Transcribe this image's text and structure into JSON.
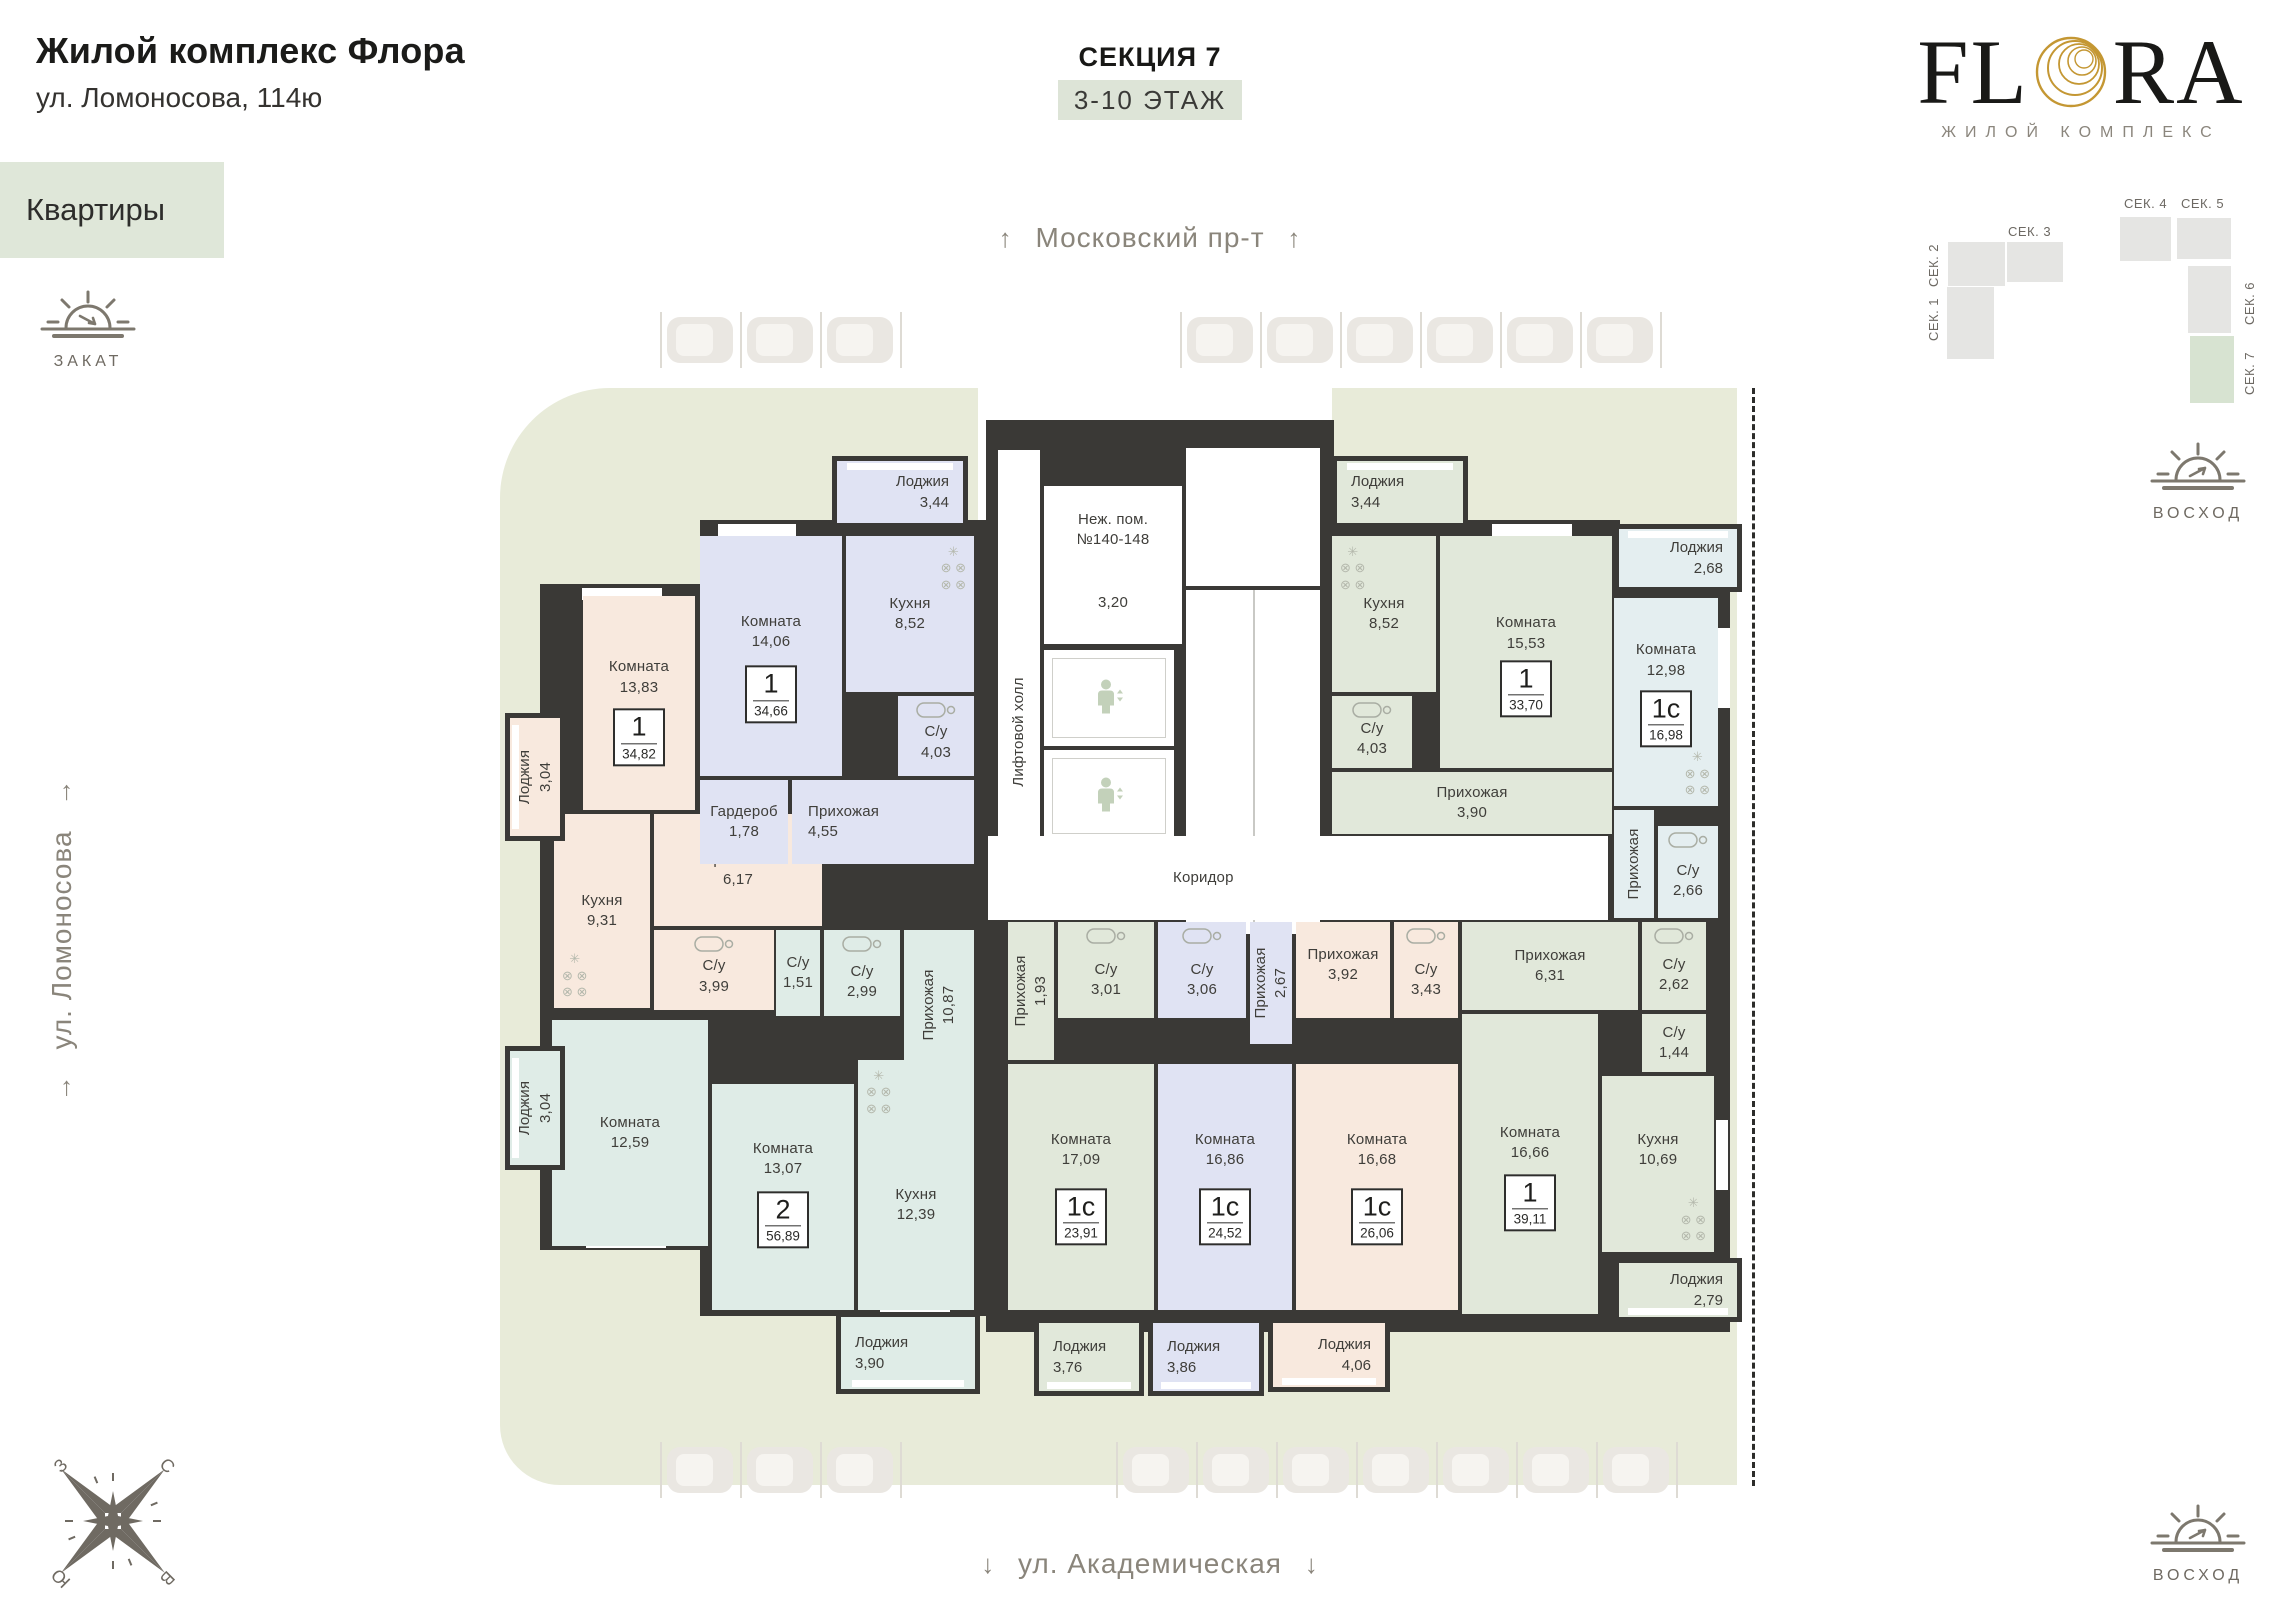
{
  "header": {
    "title": "Жилой комплекс Флора",
    "address": "ул. Ломоносова, 114ю",
    "nav_label": "Квартиры",
    "section_title": "СЕКЦИЯ 7",
    "floors_label": "3-10 ЭТАЖ"
  },
  "logo": {
    "pre": "FL",
    "post": "RA",
    "subtitle": "ЖИЛОЙ КОМПЛЕКС"
  },
  "site_map": {
    "sections": [
      {
        "label": "СЕК. 1"
      },
      {
        "label": "СЕК. 2"
      },
      {
        "label": "СЕК. 3"
      },
      {
        "label": "СЕК. 4"
      },
      {
        "label": "СЕК. 5"
      },
      {
        "label": "СЕК. 6"
      },
      {
        "label": "СЕК. 7"
      }
    ]
  },
  "streets": {
    "top": {
      "text": "Московский пр-т",
      "arrow": "↑"
    },
    "bottom": {
      "text": "ул. Академическая",
      "arrow": "↓"
    },
    "left": {
      "text": "ул. Ломоносова",
      "arrow": "→"
    }
  },
  "sun": {
    "sunset": "ЗАКАТ",
    "sunrise": "ВОСХОД"
  },
  "compass": {
    "n": "С",
    "e": "В",
    "s": "Ю",
    "w": "З"
  },
  "colors": {
    "beige": "#f8e9de",
    "blue": "#e0e3f3",
    "green": "#e1e8da",
    "teal": "#dfece7",
    "cyan": "#e4eef0",
    "white": "#ffffff",
    "wall": "#3a3936",
    "sage": "#e8ebd9",
    "gold": "#c49733",
    "nav_bg": "#dfe7d9",
    "map_active": "#d7e3d1"
  },
  "plan": {
    "rooms": [
      {
        "id": "komnata-13-83",
        "label": "Комната",
        "area": "13,83",
        "x": 583,
        "y": 596,
        "w": 112,
        "h": 214,
        "c": "beige",
        "badge": {
          "t": "1",
          "a": "34,82"
        },
        "ly": 0.38,
        "by": 0.66
      },
      {
        "id": "kuhnya-9-31",
        "label": "Кухня",
        "area": "9,31",
        "x": 554,
        "y": 814,
        "w": 96,
        "h": 194,
        "c": "beige",
        "fx": "kitchen",
        "fxp": "bl"
      },
      {
        "id": "prihozhaya-6-17",
        "label": "Прихожая",
        "area": "6,17",
        "x": 654,
        "y": 814,
        "w": 168,
        "h": 112,
        "c": "beige"
      },
      {
        "id": "su-3-99",
        "label": "С/у",
        "area": "3,99",
        "x": 654,
        "y": 930,
        "w": 120,
        "h": 80,
        "c": "beige",
        "fx": "bath",
        "ly": 0.58
      },
      {
        "id": "komnata-14-06",
        "label": "Комната",
        "area": "14,06",
        "x": 700,
        "y": 536,
        "w": 142,
        "h": 240,
        "c": "blue",
        "badge": {
          "t": "1",
          "a": "34,66"
        },
        "ly": 0.4,
        "by": 0.66
      },
      {
        "id": "kuhnya-8-52a",
        "label": "Кухня",
        "area": "8,52",
        "x": 846,
        "y": 536,
        "w": 128,
        "h": 156,
        "c": "blue",
        "fx": "kitchen",
        "fxp": "tr"
      },
      {
        "id": "garderob-1-78",
        "label": "Гардероб",
        "area": "1,78",
        "x": 700,
        "y": 780,
        "w": 88,
        "h": 84,
        "c": "blue"
      },
      {
        "id": "prihozhaya-4-55",
        "label": "Прихожая",
        "area": "4,55",
        "x": 792,
        "y": 780,
        "w": 182,
        "h": 84,
        "c": "blue",
        "align": "left",
        "pad": 16
      },
      {
        "id": "su-4-03a",
        "label": "С/у",
        "area": "4,03",
        "x": 898,
        "y": 696,
        "w": 76,
        "h": 80,
        "c": "blue",
        "fx": "bath",
        "ly": 0.58
      },
      {
        "id": "kuhnya-8-52b",
        "label": "Кухня",
        "area": "8,52",
        "x": 1332,
        "y": 536,
        "w": 104,
        "h": 156,
        "c": "green",
        "fx": "kitchen",
        "fxp": "tl"
      },
      {
        "id": "komnata-15-53",
        "label": "Комната",
        "area": "15,53",
        "x": 1440,
        "y": 536,
        "w": 172,
        "h": 232,
        "c": "green",
        "badge": {
          "t": "1",
          "a": "33,70"
        },
        "ly": 0.42,
        "by": 0.66
      },
      {
        "id": "su-4-03b",
        "label": "С/у",
        "area": "4,03",
        "x": 1332,
        "y": 696,
        "w": 80,
        "h": 72,
        "c": "green",
        "fx": "bath",
        "ly": 0.6
      },
      {
        "id": "prihozhaya-3-90",
        "label": "Прихожая",
        "area": "3,90",
        "x": 1332,
        "y": 772,
        "w": 280,
        "h": 62,
        "c": "green"
      },
      {
        "id": "komnata-12-98",
        "label": "Комната",
        "area": "12,98",
        "x": 1614,
        "y": 598,
        "w": 104,
        "h": 208,
        "c": "cyan",
        "badge": {
          "t": "1с",
          "a": "16,98"
        },
        "ly": 0.3,
        "by": 0.58,
        "fx": "kitchen",
        "fxp": "br"
      },
      {
        "id": "prihozhaya-v",
        "label": "Прихожая",
        "area": "",
        "x": 1614,
        "y": 810,
        "w": 40,
        "h": 108,
        "c": "cyan",
        "vertical": true
      },
      {
        "id": "su-2-66",
        "label": "С/у",
        "area": "2,66",
        "x": 1658,
        "y": 826,
        "w": 60,
        "h": 92,
        "c": "cyan",
        "fx": "bath",
        "ly": 0.6
      },
      {
        "id": "lift-hall",
        "label": "Лифтовой холл",
        "area": "",
        "x": 998,
        "y": 450,
        "w": 42,
        "h": 470,
        "c": "white",
        "vertical": true,
        "ly": 0.6
      },
      {
        "id": "nezh-pom",
        "label": "Неж. пом.",
        "label2": "№140-148",
        "area": "3,20",
        "x": 1044,
        "y": 486,
        "w": 138,
        "h": 158,
        "c": "white",
        "ly": 0.28,
        "by": 0.74
      },
      {
        "id": "elevator-a",
        "label": "",
        "area": "",
        "x": 1044,
        "y": 650,
        "w": 130,
        "h": 96,
        "c": "white",
        "icon": "elevator"
      },
      {
        "id": "elevator-b",
        "label": "",
        "area": "",
        "x": 1044,
        "y": 750,
        "w": 130,
        "h": 92,
        "c": "white",
        "icon": "elevator"
      },
      {
        "id": "stairs-landing",
        "label": "",
        "area": "",
        "x": 1186,
        "y": 448,
        "w": 134,
        "h": 138,
        "c": "white"
      },
      {
        "id": "stairs",
        "label": "",
        "area": "",
        "x": 1186,
        "y": 590,
        "w": 134,
        "h": 344,
        "c": "white",
        "pattern": "stairs"
      },
      {
        "id": "corridor",
        "label": "Коридор",
        "area": "",
        "x": 988,
        "y": 836,
        "w": 620,
        "h": 84,
        "c": "white",
        "align": "left",
        "pad": 185
      },
      {
        "id": "su-1-51",
        "label": "С/у",
        "area": "1,51",
        "x": 776,
        "y": 930,
        "w": 44,
        "h": 86,
        "c": "teal"
      },
      {
        "id": "su-2-99",
        "label": "С/у",
        "area": "2,99",
        "x": 824,
        "y": 930,
        "w": 76,
        "h": 86,
        "c": "teal",
        "fx": "bath",
        "ly": 0.6
      },
      {
        "id": "prihozhaya-10-87",
        "label": "Прихожая",
        "area": "10,87",
        "x": 904,
        "y": 930,
        "w": 70,
        "h": 150,
        "c": "teal",
        "vertical": true
      },
      {
        "id": "komnata-12-59",
        "label": "Комната",
        "area": "12,59",
        "x": 552,
        "y": 1020,
        "w": 156,
        "h": 226,
        "c": "teal"
      },
      {
        "id": "komnata-13-07",
        "label": "Комната",
        "area": "13,07",
        "x": 712,
        "y": 1084,
        "w": 142,
        "h": 226,
        "c": "teal",
        "badge": {
          "t": "2",
          "a": "56,89"
        },
        "ly": 0.33,
        "by": 0.6
      },
      {
        "id": "kuhnya-12-39",
        "label": "Кухня",
        "area": "12,39",
        "x": 858,
        "y": 1060,
        "w": 116,
        "h": 250,
        "c": "teal",
        "ly": 0.58,
        "fx": "kitchen",
        "fxp": "tl"
      },
      {
        "id": "prihozhaya-1-93",
        "label": "Прихожая",
        "area": "1,93",
        "x": 1008,
        "y": 922,
        "w": 46,
        "h": 138,
        "c": "green",
        "vertical": true
      },
      {
        "id": "su-3-01",
        "label": "С/у",
        "area": "3,01",
        "x": 1058,
        "y": 922,
        "w": 96,
        "h": 96,
        "c": "green",
        "fx": "bath",
        "ly": 0.6
      },
      {
        "id": "komnata-17-09",
        "label": "Комната",
        "area": "17,09",
        "x": 1008,
        "y": 1064,
        "w": 146,
        "h": 246,
        "c": "green",
        "badge": {
          "t": "1с",
          "a": "23,91"
        },
        "ly": 0.35,
        "by": 0.62
      },
      {
        "id": "su-3-06",
        "label": "С/у",
        "area": "3,06",
        "x": 1158,
        "y": 922,
        "w": 88,
        "h": 96,
        "c": "blue",
        "fx": "bath",
        "ly": 0.6
      },
      {
        "id": "prihozhaya-2-67",
        "label": "Прихожая",
        "area": "2,67",
        "x": 1250,
        "y": 922,
        "w": 42,
        "h": 122,
        "c": "blue",
        "vertical": true
      },
      {
        "id": "komnata-16-86",
        "label": "Комната",
        "area": "16,86",
        "x": 1158,
        "y": 1064,
        "w": 134,
        "h": 246,
        "c": "blue",
        "badge": {
          "t": "1с",
          "a": "24,52"
        },
        "ly": 0.35,
        "by": 0.62
      },
      {
        "id": "prihozhaya-3-92",
        "label": "Прихожая",
        "area": "3,92",
        "x": 1296,
        "y": 922,
        "w": 94,
        "h": 96,
        "c": "beige",
        "ly": 0.45
      },
      {
        "id": "su-3-43",
        "label": "С/у",
        "area": "3,43",
        "x": 1394,
        "y": 922,
        "w": 64,
        "h": 96,
        "c": "beige",
        "fx": "bath",
        "ly": 0.6
      },
      {
        "id": "komnata-16-68",
        "label": "Комната",
        "area": "16,68",
        "x": 1296,
        "y": 1064,
        "w": 162,
        "h": 246,
        "c": "beige",
        "badge": {
          "t": "1с",
          "a": "26,06"
        },
        "ly": 0.35,
        "by": 0.62
      },
      {
        "id": "prihozhaya-6-31",
        "label": "Прихожая",
        "area": "6,31",
        "x": 1462,
        "y": 922,
        "w": 176,
        "h": 88,
        "c": "green"
      },
      {
        "id": "su-2-62",
        "label": "С/у",
        "area": "2,62",
        "x": 1642,
        "y": 922,
        "w": 64,
        "h": 88,
        "c": "green",
        "fx": "bath",
        "ly": 0.6
      },
      {
        "id": "su-1-44",
        "label": "С/у",
        "area": "1,44",
        "x": 1642,
        "y": 1014,
        "w": 64,
        "h": 58,
        "c": "green"
      },
      {
        "id": "komnata-16-66",
        "label": "Комната",
        "area": "16,66",
        "x": 1462,
        "y": 1014,
        "w": 136,
        "h": 300,
        "c": "green",
        "badge": {
          "t": "1",
          "a": "39,11"
        },
        "ly": 0.43,
        "by": 0.63
      },
      {
        "id": "kuhnya-10-69",
        "label": "Кухня",
        "area": "10,69",
        "x": 1602,
        "y": 1076,
        "w": 112,
        "h": 176,
        "c": "green",
        "ly": 0.42,
        "fx": "kitchen",
        "fxp": "br"
      }
    ],
    "loggias": [
      {
        "id": "loggia-3-04a",
        "label": "Лоджия",
        "area": "3,04",
        "x": 505,
        "y": 713,
        "w": 60,
        "h": 128,
        "c": "beige",
        "vertical": true,
        "window": "left"
      },
      {
        "id": "loggia-3-04b",
        "label": "Лоджия",
        "area": "3,04",
        "x": 505,
        "y": 1046,
        "w": 60,
        "h": 124,
        "c": "teal",
        "vertical": true,
        "window": "left"
      },
      {
        "id": "loggia-3-44a",
        "label": "Лоджия",
        "area": "3,44",
        "x": 832,
        "y": 456,
        "w": 136,
        "h": 72,
        "c": "blue",
        "window": "top",
        "align": "right"
      },
      {
        "id": "loggia-3-44b",
        "label": "Лоджия",
        "area": "3,44",
        "x": 1332,
        "y": 456,
        "w": 136,
        "h": 72,
        "c": "green",
        "window": "top",
        "align": "left"
      },
      {
        "id": "loggia-2-68",
        "label": "Лоджия",
        "area": "2,68",
        "x": 1614,
        "y": 524,
        "w": 128,
        "h": 68,
        "c": "cyan",
        "window": "top",
        "align": "right"
      },
      {
        "id": "loggia-3-90",
        "label": "Лоджия",
        "area": "3,90",
        "x": 836,
        "y": 1312,
        "w": 144,
        "h": 82,
        "c": "teal",
        "window": "bottom",
        "align": "left"
      },
      {
        "id": "loggia-3-76",
        "label": "Лоджия",
        "area": "3,76",
        "x": 1034,
        "y": 1318,
        "w": 110,
        "h": 78,
        "c": "green",
        "window": "bottom",
        "align": "left"
      },
      {
        "id": "loggia-3-86",
        "label": "Лоджия",
        "area": "3,86",
        "x": 1148,
        "y": 1318,
        "w": 116,
        "h": 78,
        "c": "blue",
        "window": "bottom",
        "align": "left"
      },
      {
        "id": "loggia-4-06",
        "label": "Лоджия",
        "area": "4,06",
        "x": 1268,
        "y": 1318,
        "w": 122,
        "h": 74,
        "c": "beige",
        "window": "bottom",
        "align": "right"
      },
      {
        "id": "loggia-2-79",
        "label": "Лоджия",
        "area": "2,79",
        "x": 1614,
        "y": 1258,
        "w": 128,
        "h": 64,
        "c": "green",
        "window": "bottom",
        "align": "right"
      }
    ]
  }
}
